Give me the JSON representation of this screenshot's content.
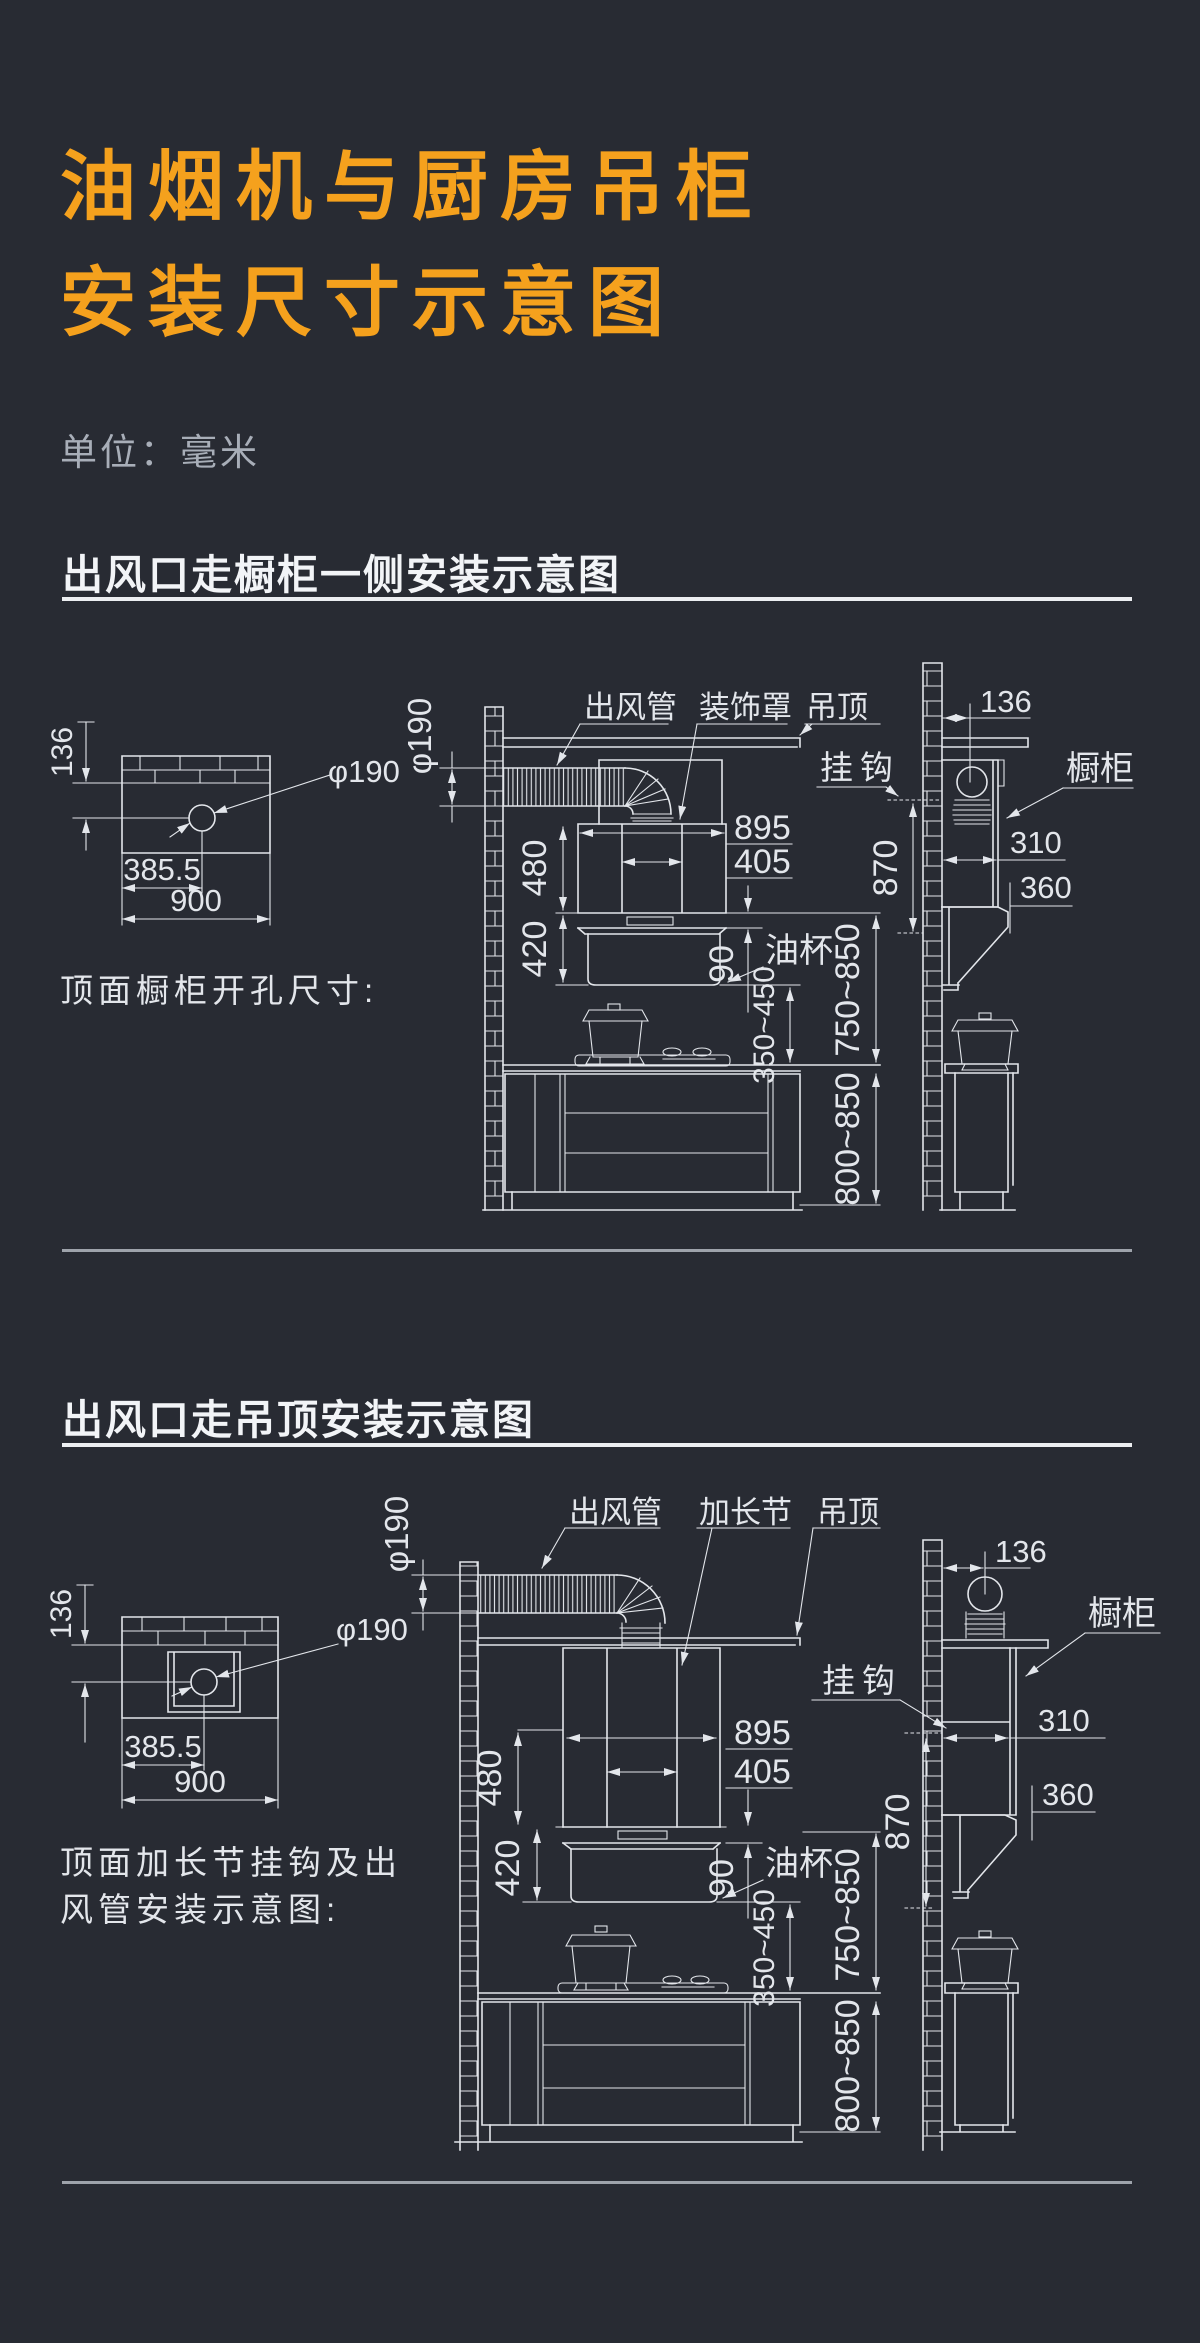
{
  "page": {
    "title_line1": "油烟机与厨房吊柜",
    "title_line2": "安装尺寸示意图",
    "unit_label": "单位：毫米",
    "colors": {
      "accent": "#F5A11D",
      "background": "#282B33",
      "line": "#E3E6EB",
      "muted": "#A8AEB8"
    }
  },
  "section1": {
    "heading": "出风口走橱柜一侧安装示意图",
    "cutout": {
      "wall_offset": "136",
      "hole_dia": "φ190",
      "hole_offset": "385.5",
      "cabinet_width": "900",
      "caption": "顶面橱柜开孔尺寸:"
    },
    "elevation": {
      "duct_dia": "φ190",
      "duct_label": "出风管",
      "cover_label": "装饰罩",
      "ceiling_label": "吊顶",
      "hood_width": "895",
      "outlet_width": "405",
      "upper_height": "480",
      "lower_height": "420",
      "panel_height": "90",
      "oil_cup_label": "油杯",
      "hood_to_counter": "350~450",
      "body_to_counter": "750~850",
      "counter_height": "800~850"
    },
    "side": {
      "wall_offset": "136",
      "hook_label": "挂钩",
      "cabinet_label": "橱柜",
      "cabinet_depth": "310",
      "hood_depth": "360",
      "hook_to_bottom": "870"
    }
  },
  "section2": {
    "heading": "出风口走吊顶安装示意图",
    "cutout": {
      "wall_offset": "136",
      "hole_dia": "φ190",
      "hole_offset": "385.5",
      "cabinet_width": "900",
      "caption_line1": "顶面加长节挂钩及出",
      "caption_line2": "风管安装示意图:"
    },
    "elevation": {
      "duct_dia": "φ190",
      "duct_label": "出风管",
      "extension_label": "加长节",
      "ceiling_label": "吊顶",
      "hook_label": "挂钩",
      "hood_width": "895",
      "outlet_width": "405",
      "upper_height": "480",
      "lower_height": "420",
      "panel_height": "90",
      "oil_cup_label": "油杯",
      "hood_to_counter": "350~450",
      "body_to_counter": "750~850",
      "counter_height": "800~850"
    },
    "side": {
      "wall_offset": "136",
      "cabinet_label": "橱柜",
      "cabinet_depth": "310",
      "hood_depth": "360",
      "hook_to_bottom": "870"
    }
  }
}
